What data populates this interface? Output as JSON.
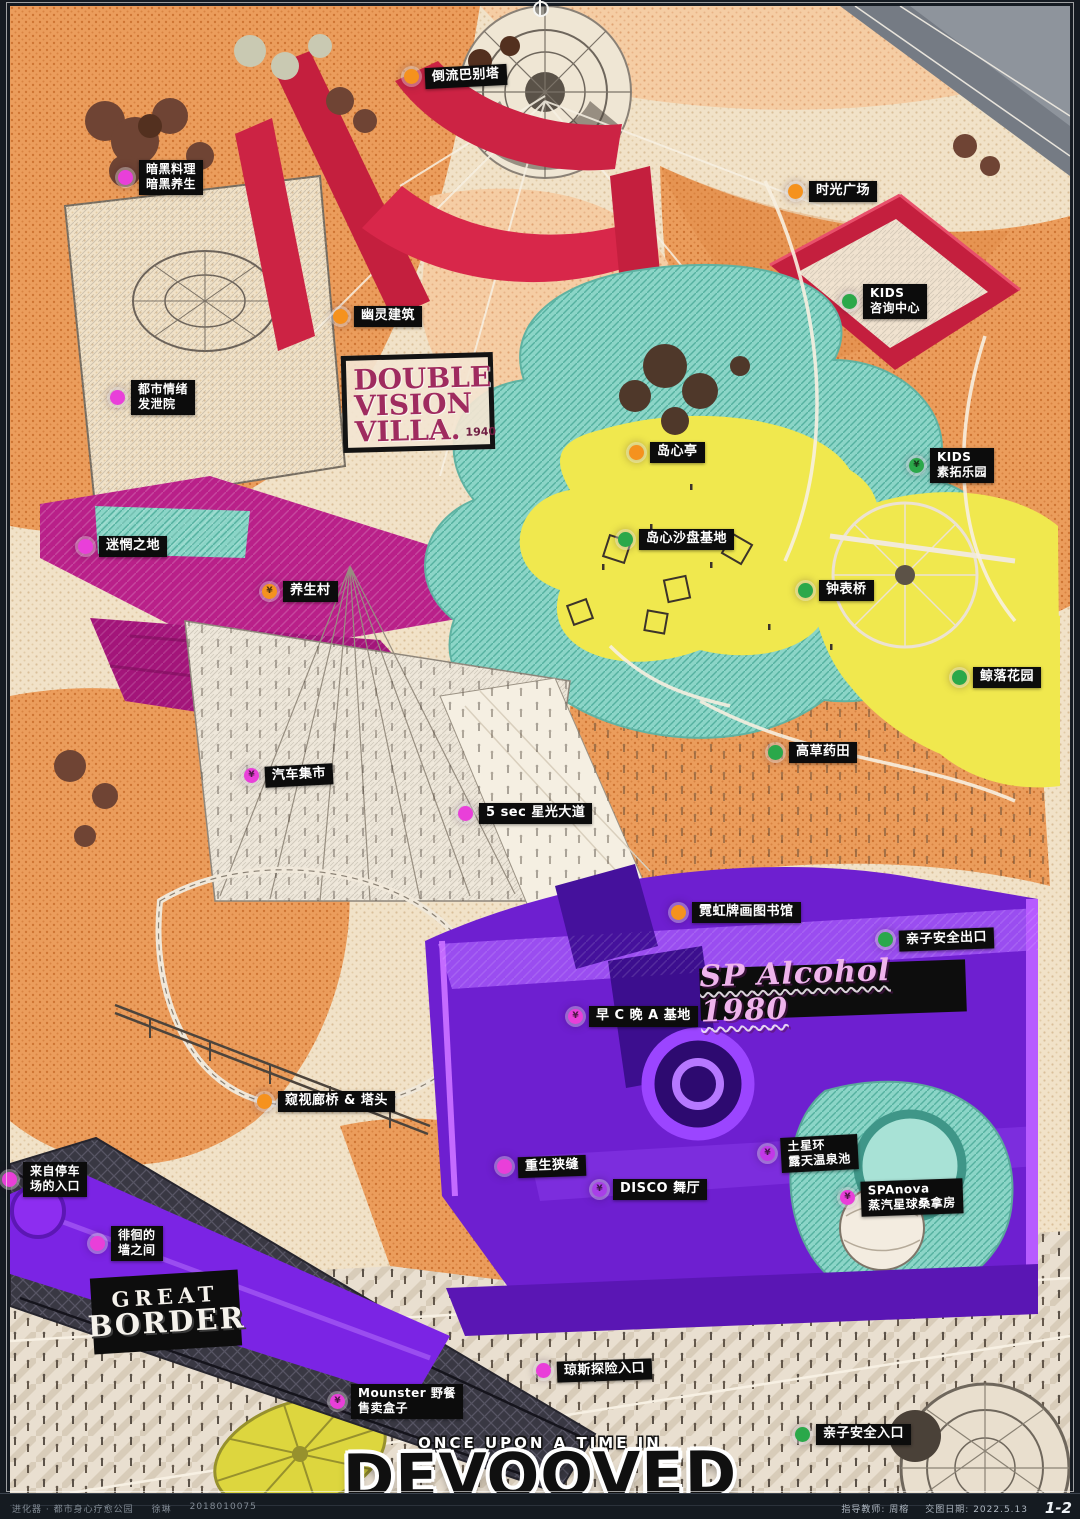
{
  "title_block": {
    "kicker": "ONCE UPON A TIME IN",
    "title": "DEVOOVED"
  },
  "logos": {
    "double_vision": {
      "line1": "DOUBLE",
      "line2": "VISION",
      "line3": "VILLA.",
      "year": "1940"
    },
    "sp_alcohol": {
      "text": "SP Alcohol 1980"
    },
    "great_border": {
      "line1": "GREAT",
      "line2": "BORDER"
    }
  },
  "footer_bar": {
    "project": "进化器 · 都市身心疗愈公园",
    "author": "徐琳",
    "student_id": "2018010075",
    "advisor": "指导教师: 周榕",
    "date": "交图日期: 2022.5.13",
    "page": "1-2"
  },
  "palette": {
    "orange_dot": "#f5921e",
    "green_dot": "#2ba84a",
    "magenta_dot": "#e93fd9",
    "purple_dot": "#a93fe8",
    "map_red": "#cc2344",
    "map_magenta": "#b92089",
    "map_purple": "#6e1fd0",
    "map_teal": "#8bd5c7",
    "map_yellow": "#f0e84e"
  },
  "markers": [
    {
      "label": "倒流巴别塔",
      "dot": "#f5921e"
    },
    {
      "label": "暗黑料理\n暗黑养生",
      "dot": "#e93fd9"
    },
    {
      "label": "时光广场",
      "dot": "#f5921e"
    },
    {
      "label": "幽灵建筑",
      "dot": "#f5921e"
    },
    {
      "label": "KIDS\n咨询中心",
      "dot": "#2ba84a"
    },
    {
      "label": "都市情绪\n发泄院",
      "dot": "#e93fd9"
    },
    {
      "label": "岛心亭",
      "dot": "#f5921e"
    },
    {
      "label": "KIDS\n素拓乐园",
      "dot": "#2ba84a",
      "sym": "¥"
    },
    {
      "label": "岛心沙盘基地",
      "dot": "#2ba84a"
    },
    {
      "label": "迷惘之地",
      "dot": "#e93fd9"
    },
    {
      "label": "养生村",
      "dot": "#f5921e",
      "sym": "¥"
    },
    {
      "label": "钟表桥",
      "dot": "#2ba84a"
    },
    {
      "label": "鲸落花园",
      "dot": "#2ba84a"
    },
    {
      "label": "高草药田",
      "dot": "#2ba84a"
    },
    {
      "label": "汽车集市",
      "dot": "#e93fd9",
      "sym": "¥"
    },
    {
      "label": "5 sec 星光大道",
      "dot": "#e93fd9"
    },
    {
      "label": "霓虹牌画图书馆",
      "dot": "#f5921e"
    },
    {
      "label": "亲子安全出口",
      "dot": "#2ba84a"
    },
    {
      "label": "早 C 晚 A 基地",
      "dot": "#e93fd9",
      "sym": "¥"
    },
    {
      "label": "窥视廊桥 & 塔头",
      "dot": "#f5921e"
    },
    {
      "label": "重生狭缝",
      "dot": "#e93fd9"
    },
    {
      "label": "DISCO 舞厅",
      "dot": "#a93fe8",
      "sym": "¥"
    },
    {
      "label": "土星环\n露天温泉池",
      "dot": "#c238e8",
      "sym": "¥"
    },
    {
      "label": "SPAnova\n蒸汽星球桑拿房",
      "dot": "#e93fd9",
      "sym": "¥"
    },
    {
      "label": "来自停车\n场的入口",
      "dot": "#e93fd9"
    },
    {
      "label": "徘徊的\n墙之间",
      "dot": "#e93fd9"
    },
    {
      "label": "琼斯探险入口",
      "dot": "#e93fd9"
    },
    {
      "label": "Mounster 野餐\n售卖盒子",
      "dot": "#e93fd9",
      "sym": "¥"
    },
    {
      "label": "亲子安全入口",
      "dot": "#2ba84a"
    }
  ]
}
